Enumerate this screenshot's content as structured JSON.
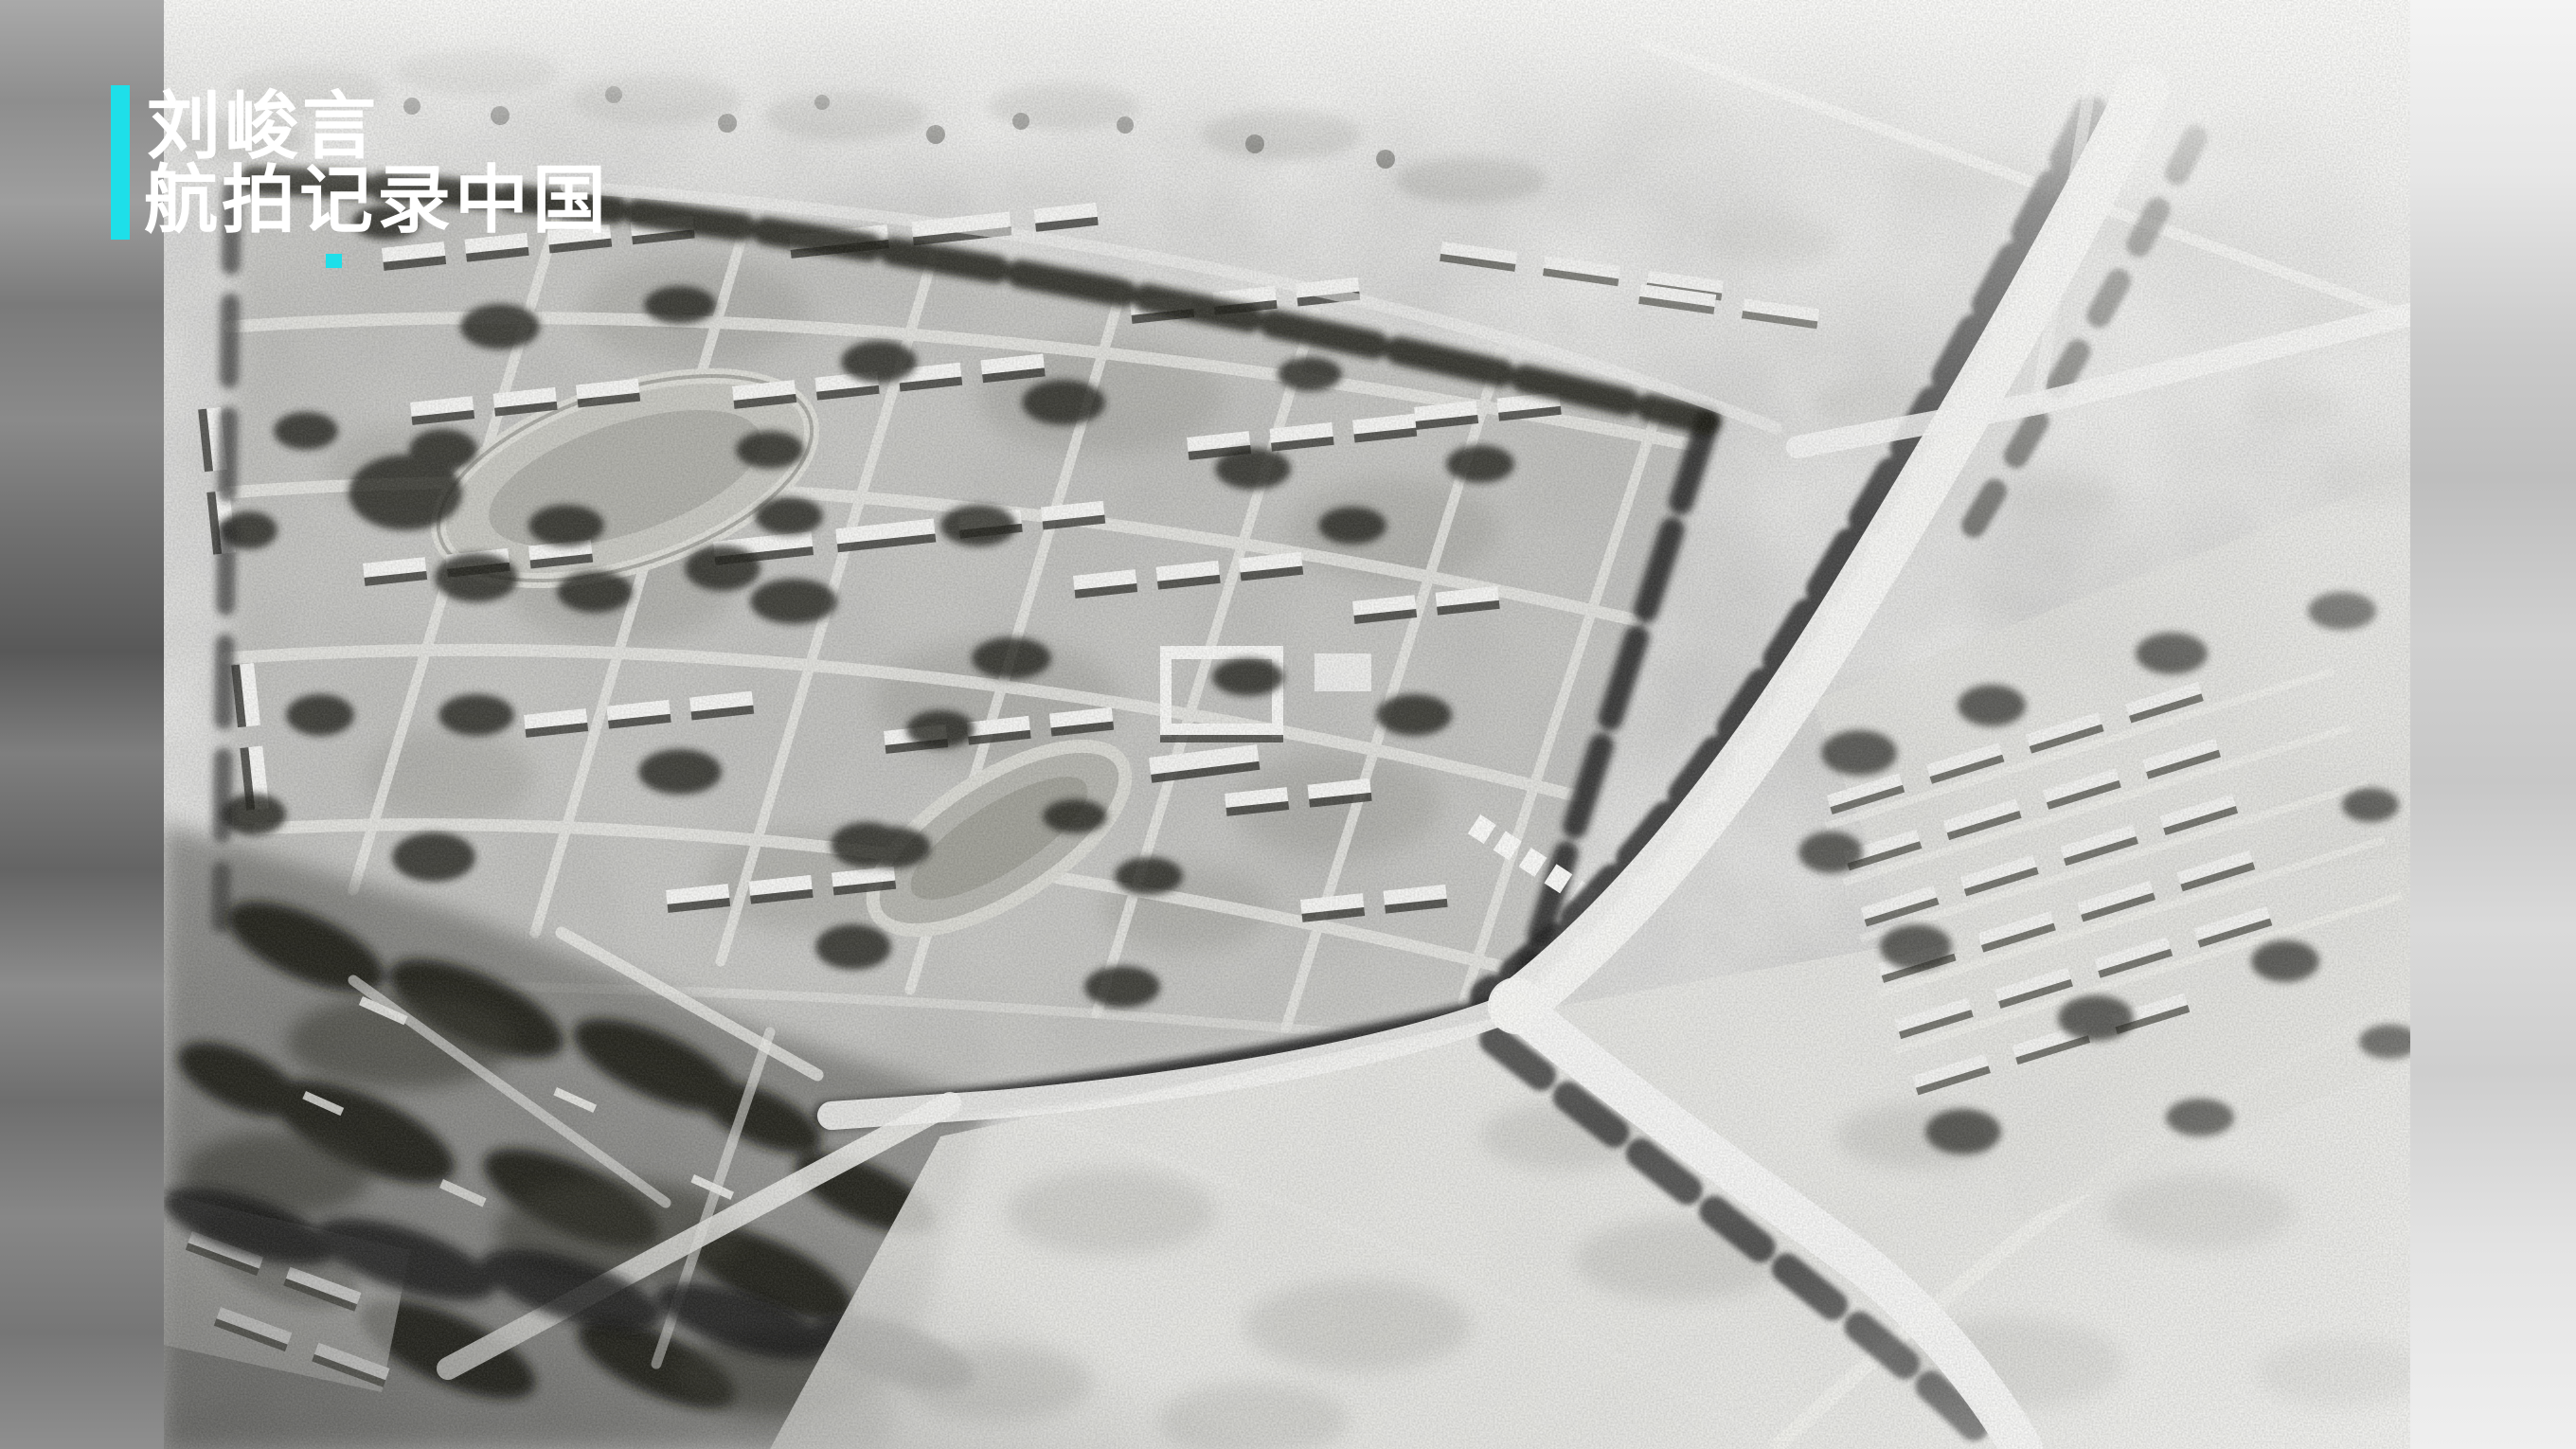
{
  "watermark": {
    "line1": "刘峻言",
    "line2": "航拍记录中国",
    "text_color": "#ffffff",
    "accent_color": "#1EDFE9"
  },
  "photo": {
    "kind": "black-and-white aerial photograph",
    "subject": "Historical oblique aerial view of a walled rectangular campus with two oval running tracks, grids of low white-roofed buildings, tree-lined perimeter roads, a wide diagonal road with junctions on the right, rows of barracks beyond the road, dark wooded area at lower left and pale open farmland around",
    "tones": {
      "paper_white": "#f8f8f6",
      "field_gray": "#b3b3af",
      "tree_dark": "#1f1f1d"
    }
  }
}
